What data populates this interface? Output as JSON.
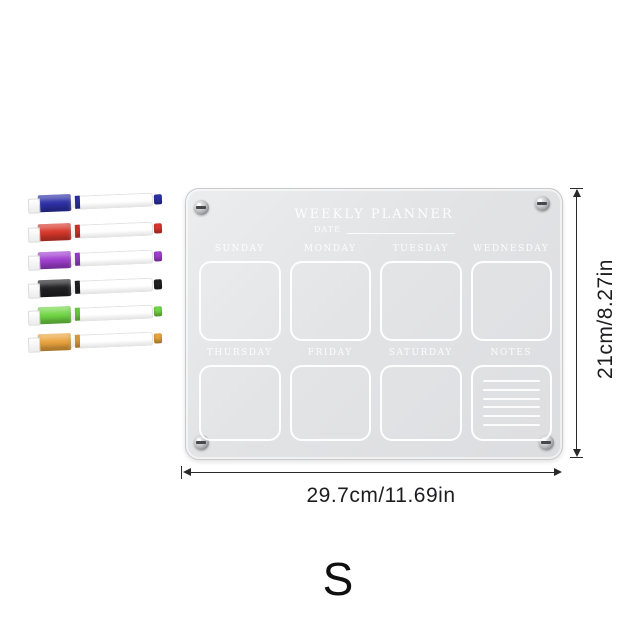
{
  "board": {
    "title": "WEEKLY PLANNER",
    "date_label": "DATE",
    "days_row1": [
      "SUNDAY",
      "MONDAY",
      "TUESDAY",
      "WEDNESDAY"
    ],
    "days_row2": [
      "THURSDAY",
      "FRIDAY",
      "SATURDAY",
      "NOTES"
    ],
    "notes_lines": 6,
    "surface_color": "#e3e4e6",
    "text_color": "#ffffff"
  },
  "markers": [
    {
      "name": "blue",
      "color": "#2e31a8"
    },
    {
      "name": "red",
      "color": "#d8382b"
    },
    {
      "name": "purple",
      "color": "#a13fd0"
    },
    {
      "name": "black",
      "color": "#212124"
    },
    {
      "name": "green",
      "color": "#72d645"
    },
    {
      "name": "orange",
      "color": "#eaa43e"
    }
  ],
  "dimensions": {
    "height_label": "21cm/8.27in",
    "width_label": "29.7cm/11.69in",
    "line_color": "#2a2a2a",
    "text_color": "#1d1d1f"
  },
  "size_label": "S"
}
